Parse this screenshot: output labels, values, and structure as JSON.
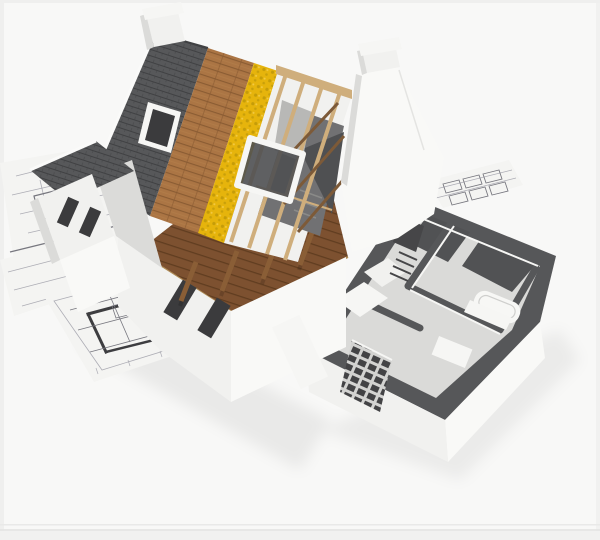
{
  "scene": {
    "caption": "3D architectural cutaway render of a house under construction, roof layers exposed, sitting on blueprint floor plans",
    "colors": {
      "background": "#f8f8f7",
      "edge_tint": "#efefee",
      "bottom_line_1": "#e9e9e8",
      "bottom_line_2": "#e4e4e3",
      "bottom_band": "#f1f1f0",
      "paper": "#f4f4f2",
      "paper_edge": "#e2e2e0",
      "paper_line": "#adadb5",
      "paper_line_strong": "#77777f",
      "plan_wall": "#3d3d40",
      "shingle_base": "#57585a",
      "shingle_line": "#404143",
      "shingle_verge": "#fafaf9",
      "wood_plank": "#ab7544",
      "wood_plank_line": "#8a5c33",
      "wood_plank_hi": "#c08a52",
      "insulation": "#e6b40c",
      "insulation_dot": "#c59c09",
      "insulation_hi": "#f2ca45",
      "attic_floor": "#7d5130",
      "attic_floor_line": "#603d20",
      "beam_light": "#cfae7c",
      "beam_mid": "#ad8a55",
      "truss_dark": "#7d5a38",
      "rafter_tail": "#8a5e36",
      "wall_white": "#f1f1ef",
      "wall_bright": "#f9f9f7",
      "wall_shade": "#dbdbd9",
      "window_dark": "#3b3b3d",
      "frame_white": "#f6f6f4",
      "attic_interior": "#717173",
      "attic_dark": "#4f5052",
      "attic_panel": "#b8b8b6",
      "step_line": "#8a8a88",
      "cut_top": "#565759",
      "floor_light": "#dadad8",
      "floor_dark": "#515254",
      "appliance": "#464648",
      "brick_bg": "#434345",
      "brick_light": "#d3d3d1",
      "fixture": "#f7f7f5",
      "fixture_line": "#cfcfcd",
      "shadow": "#000000"
    }
  }
}
